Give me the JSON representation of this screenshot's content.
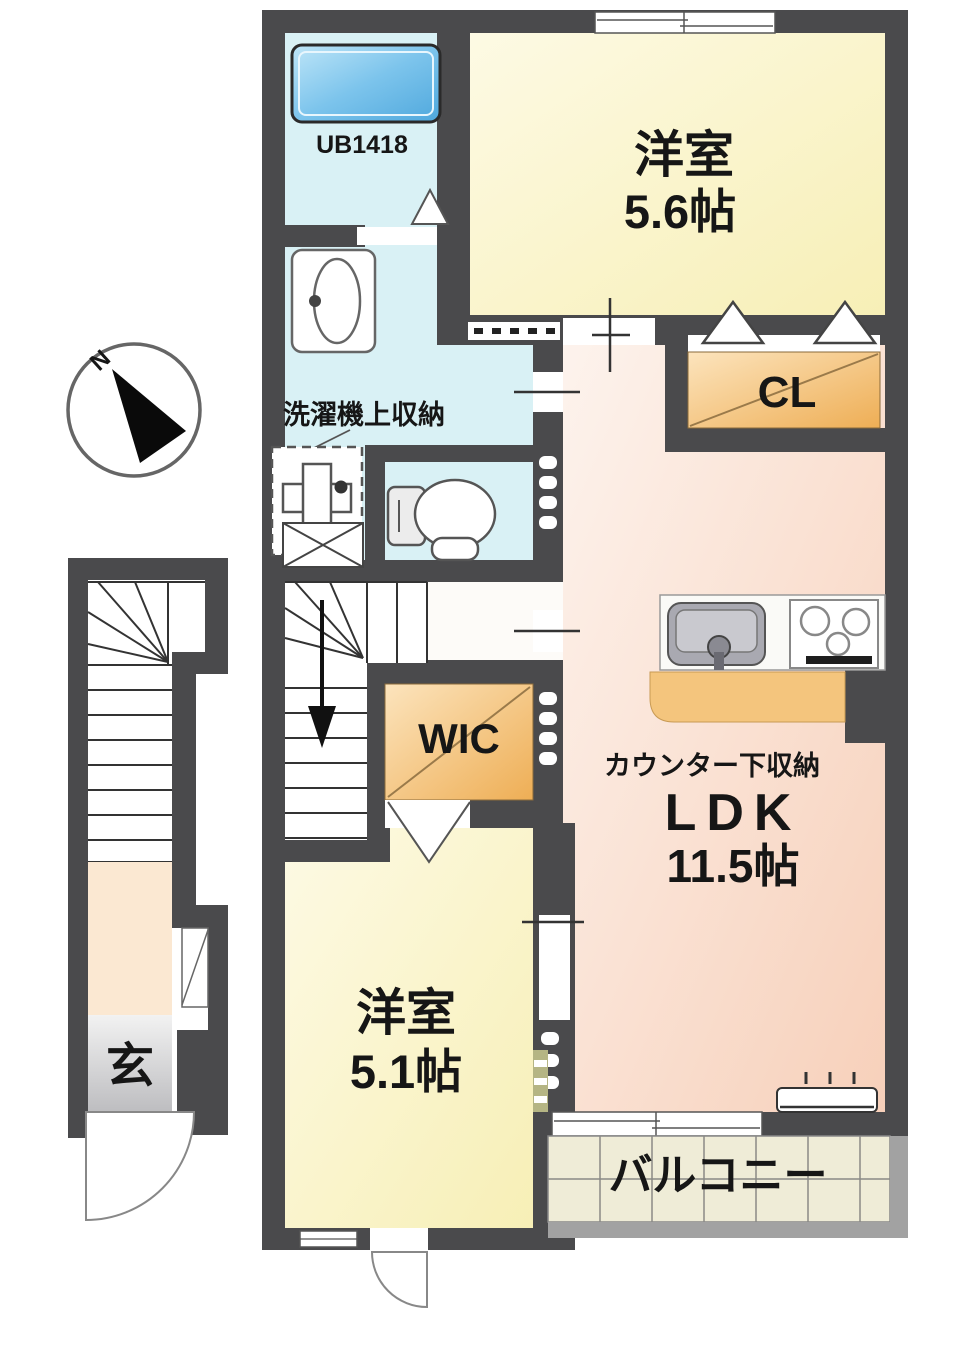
{
  "plan": {
    "type": "apartment-floor-plan",
    "compass": {
      "north_label": "N"
    },
    "rooms": {
      "unit_bath": {
        "label": "UB1418"
      },
      "bedroom_top": {
        "name": "洋室",
        "size": "5.6帖"
      },
      "closet": {
        "label": "CL"
      },
      "washroom": {
        "label": "洗濯機上収納"
      },
      "wic": {
        "label": "WIC"
      },
      "ldk": {
        "name": "LDK",
        "size": "11.5帖",
        "counter_label": "カウンター下収納"
      },
      "bedroom_bottom": {
        "name": "洋室",
        "size": "5.1帖"
      },
      "balcony": {
        "label": "バルコニー"
      },
      "entrance": {
        "label": "玄"
      }
    },
    "colors": {
      "wall": "#4a4a4c",
      "room_yellow": "#fbf5cf",
      "room_pink": "#fae0d2",
      "room_cyan": "#d9f1f5",
      "closet_orange": "#f0b863",
      "tub_blue": "#6cbcea",
      "balcony_tile": "#efecd7",
      "entrance_gray": "#c9c9cb",
      "landing_peach": "#fbe8d2"
    }
  }
}
